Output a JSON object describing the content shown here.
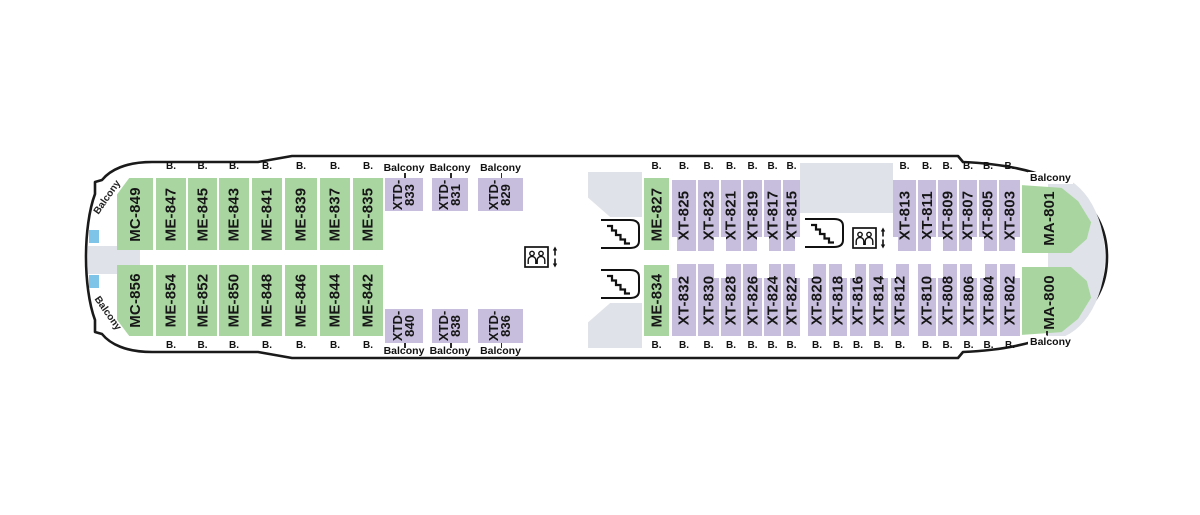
{
  "labels": {
    "b": "B.",
    "balcony": "Balcony"
  },
  "colors": {
    "cabin_green": "#a8d5a0",
    "cabin_purple": "#c7bedd",
    "deck_gray": "#dfe2e8",
    "marker_blue": "#7ec4e8",
    "hull_outline": "#1a1a1a"
  },
  "deck": {
    "cabins": [
      {
        "id": "MC-849",
        "kind": "mc",
        "row": "top",
        "x": 117,
        "w": 36,
        "badge": null
      },
      {
        "id": "ME-847",
        "kind": "me",
        "row": "top",
        "x": 156,
        "w": 30,
        "badge": "B."
      },
      {
        "id": "ME-845",
        "kind": "me",
        "row": "top",
        "x": 188,
        "w": 29,
        "badge": "B."
      },
      {
        "id": "ME-843",
        "kind": "me",
        "row": "top",
        "x": 219,
        "w": 30,
        "badge": "B."
      },
      {
        "id": "ME-841",
        "kind": "me",
        "row": "top",
        "x": 252,
        "w": 30,
        "badge": "B."
      },
      {
        "id": "ME-839",
        "kind": "me",
        "row": "top",
        "x": 285,
        "w": 32,
        "badge": "B."
      },
      {
        "id": "ME-837",
        "kind": "me",
        "row": "top",
        "x": 320,
        "w": 30,
        "badge": "B."
      },
      {
        "id": "ME-835",
        "kind": "me",
        "row": "top",
        "x": 353,
        "w": 30,
        "badge": "B."
      },
      {
        "id": "XTD-833",
        "kind": "xtd",
        "row": "top",
        "x": 385,
        "w": 38,
        "badge": "Balcony"
      },
      {
        "id": "XTD-831",
        "kind": "xtd",
        "row": "top",
        "x": 432,
        "w": 36,
        "badge": "Balcony"
      },
      {
        "id": "XTD-829",
        "kind": "xtd",
        "row": "top",
        "x": 478,
        "w": 45,
        "badge": "Balcony"
      },
      {
        "id": "ME-827",
        "kind": "me",
        "row": "top",
        "x": 644,
        "w": 25,
        "badge": "B."
      },
      {
        "id": "XT-825",
        "kind": "xt",
        "row": "top",
        "x": 672,
        "w": 24,
        "badge": "B.",
        "notch": "l"
      },
      {
        "id": "XT-823",
        "kind": "xt",
        "row": "top",
        "x": 698,
        "w": 21,
        "badge": "B.",
        "notch": "r"
      },
      {
        "id": "XT-821",
        "kind": "xt",
        "row": "top",
        "x": 721,
        "w": 20,
        "badge": "B.",
        "notch": "l"
      },
      {
        "id": "XT-819",
        "kind": "xt",
        "row": "top",
        "x": 743,
        "w": 19,
        "badge": "B.",
        "notch": "r"
      },
      {
        "id": "XT-817",
        "kind": "xt",
        "row": "top",
        "x": 764,
        "w": 17,
        "badge": "B.",
        "notch": "l"
      },
      {
        "id": "XT-815",
        "kind": "xt",
        "row": "top",
        "x": 783,
        "w": 17,
        "badge": "B.",
        "notch": "r"
      },
      {
        "id": "XT-813",
        "kind": "xt",
        "row": "top",
        "x": 893,
        "w": 23,
        "badge": "B.",
        "notch": "l"
      },
      {
        "id": "XT-811",
        "kind": "xt",
        "row": "top",
        "x": 918,
        "w": 18,
        "badge": "B.",
        "notch": "r"
      },
      {
        "id": "XT-809",
        "kind": "xt",
        "row": "top",
        "x": 938,
        "w": 19,
        "badge": "B.",
        "notch": "l"
      },
      {
        "id": "XT-807",
        "kind": "xt",
        "row": "top",
        "x": 959,
        "w": 18,
        "badge": "B.",
        "notch": "r"
      },
      {
        "id": "XT-805",
        "kind": "xt",
        "row": "top",
        "x": 979,
        "w": 18,
        "badge": "B.",
        "notch": "l"
      },
      {
        "id": "XT-803",
        "kind": "xt",
        "row": "top",
        "x": 999,
        "w": 21,
        "badge": "B.",
        "notch": "r"
      },
      {
        "id": "MA-801",
        "kind": "ma",
        "row": "top",
        "x": 1022,
        "w": 72,
        "badge": "Balcony"
      },
      {
        "id": "MC-856",
        "kind": "mc",
        "row": "bottom",
        "x": 117,
        "w": 36,
        "badge": null
      },
      {
        "id": "ME-854",
        "kind": "me",
        "row": "bottom",
        "x": 156,
        "w": 30,
        "badge": "B."
      },
      {
        "id": "ME-852",
        "kind": "me",
        "row": "bottom",
        "x": 188,
        "w": 29,
        "badge": "B."
      },
      {
        "id": "ME-850",
        "kind": "me",
        "row": "bottom",
        "x": 219,
        "w": 30,
        "badge": "B."
      },
      {
        "id": "ME-848",
        "kind": "me",
        "row": "bottom",
        "x": 252,
        "w": 30,
        "badge": "B."
      },
      {
        "id": "ME-846",
        "kind": "me",
        "row": "bottom",
        "x": 285,
        "w": 32,
        "badge": "B."
      },
      {
        "id": "ME-844",
        "kind": "me",
        "row": "bottom",
        "x": 320,
        "w": 30,
        "badge": "B."
      },
      {
        "id": "ME-842",
        "kind": "me",
        "row": "bottom",
        "x": 353,
        "w": 30,
        "badge": "B."
      },
      {
        "id": "XTD-840",
        "kind": "xtd",
        "row": "bottom",
        "x": 385,
        "w": 38,
        "badge": "Balcony"
      },
      {
        "id": "XTD-838",
        "kind": "xtd",
        "row": "bottom",
        "x": 432,
        "w": 36,
        "badge": "Balcony"
      },
      {
        "id": "XTD-836",
        "kind": "xtd",
        "row": "bottom",
        "x": 478,
        "w": 45,
        "badge": "Balcony"
      },
      {
        "id": "ME-834",
        "kind": "me",
        "row": "bottom",
        "x": 644,
        "w": 25,
        "badge": "B."
      },
      {
        "id": "XT-832",
        "kind": "xt",
        "row": "bottom",
        "x": 672,
        "w": 24,
        "badge": "B.",
        "notch": "l"
      },
      {
        "id": "XT-830",
        "kind": "xt",
        "row": "bottom",
        "x": 698,
        "w": 21,
        "badge": "B.",
        "notch": "r"
      },
      {
        "id": "XT-828",
        "kind": "xt",
        "row": "bottom",
        "x": 721,
        "w": 20,
        "badge": "B.",
        "notch": "l"
      },
      {
        "id": "XT-826",
        "kind": "xt",
        "row": "bottom",
        "x": 743,
        "w": 19,
        "badge": "B.",
        "notch": "r"
      },
      {
        "id": "XT-824",
        "kind": "xt",
        "row": "bottom",
        "x": 764,
        "w": 17,
        "badge": "B.",
        "notch": "l"
      },
      {
        "id": "XT-822",
        "kind": "xt",
        "row": "bottom",
        "x": 783,
        "w": 17,
        "badge": "B.",
        "notch": "r"
      },
      {
        "id": "XT-820",
        "kind": "xt",
        "row": "bottom",
        "x": 808,
        "w": 18,
        "badge": "B.",
        "notch": "l"
      },
      {
        "id": "XT-818",
        "kind": "xt",
        "row": "bottom",
        "x": 829,
        "w": 18,
        "badge": "B.",
        "notch": "r"
      },
      {
        "id": "XT-816",
        "kind": "xt",
        "row": "bottom",
        "x": 850,
        "w": 16,
        "badge": "B.",
        "notch": "l"
      },
      {
        "id": "XT-814",
        "kind": "xt",
        "row": "bottom",
        "x": 869,
        "w": 19,
        "badge": "B.",
        "notch": "r"
      },
      {
        "id": "XT-812",
        "kind": "xt",
        "row": "bottom",
        "x": 891,
        "w": 18,
        "badge": "B.",
        "notch": "l"
      },
      {
        "id": "XT-810",
        "kind": "xt",
        "row": "bottom",
        "x": 918,
        "w": 18,
        "badge": "B.",
        "notch": "r"
      },
      {
        "id": "XT-808",
        "kind": "xt",
        "row": "bottom",
        "x": 938,
        "w": 19,
        "badge": "B.",
        "notch": "l"
      },
      {
        "id": "XT-806",
        "kind": "xt",
        "row": "bottom",
        "x": 960,
        "w": 17,
        "badge": "B.",
        "notch": "r"
      },
      {
        "id": "XT-804",
        "kind": "xt",
        "row": "bottom",
        "x": 980,
        "w": 17,
        "badge": "B.",
        "notch": "l"
      },
      {
        "id": "XT-802",
        "kind": "xt",
        "row": "bottom",
        "x": 1000,
        "w": 20,
        "badge": "B.",
        "notch": "r"
      },
      {
        "id": "MA-800",
        "kind": "ma",
        "row": "bottom",
        "x": 1022,
        "w": 72,
        "badge": "Balcony"
      }
    ]
  }
}
